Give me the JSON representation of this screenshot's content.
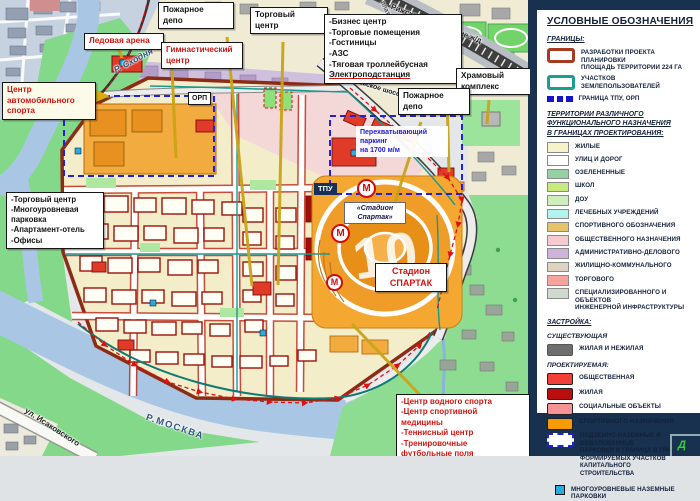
{
  "map": {
    "callouts": {
      "fire_depot_1": "Пожарное\nдепо",
      "shopping_center_top": "Торговый\nцентр",
      "business_block": "-Бизнес центр\n-Торговые помещения\n-Гостиницы\n-АЗС\n-Тяговая троллейбусная",
      "business_block_last": "Электроподстанция",
      "temple_complex": "Храмовый\nкомплекс",
      "fire_depot_2": "Пожарное\nдепо",
      "ice_arena": "Ледовая арена",
      "gym_center": "Гимнастический\nцентр",
      "auto_sport_center": "Центр\nавтомобильного\nспорта",
      "left_services": "-Торговый центр\n-Многоуровневая\nпарковка\n-Апартамент-отель\n-Офисы",
      "intercept_parking": "Перехватывающий\nпаркинг\nна 1700 м/м",
      "tpu": "ТПУ",
      "orp": "ОРП",
      "spartak_station": "«Стадион\nСпартак»",
      "stadium": "Стадион\nСПАРТАК",
      "south_sports": "-Центр водного спорта\n-Центр спортивной\nмедицины\n-Теннисный центр\n-Тренировочные\nфутбольные  поля"
    },
    "labels": {
      "river_skhodnya": "Р. Сходня",
      "river_moskva": "Р.МОСКВА",
      "isakovskogo_street": "ул. Исаковского",
      "volokolamskoe_highway": "Волоколамское шоссе",
      "railway_line": "Рижское направление ж/д",
      "platform": "платформа",
      "stadium_plot_number": "10",
      "metro_letter": "М"
    }
  },
  "legend": {
    "title": "УСЛОВНЫЕ ОБОЗНАЧЕНИЯ",
    "granitsy": {
      "header": "ГРАНИЦЫ:",
      "items": [
        {
          "label": "РАЗРАБОТКИ ПРОЕКТА ПЛАНИРОВКИ\nПЛОЩАДЬ ТЕРРИТОРИИ 224 ГА",
          "color": "#a63b20"
        },
        {
          "label": "УЧАСТКОВ ЗЕМЛЕПОЛЬЗОВАТЕЛЕЙ",
          "color": "#199e94"
        },
        {
          "label": "ГРАНИЦА ТПУ, ОРП",
          "color": "#1414cc"
        }
      ]
    },
    "territories": {
      "header": "ТЕРРИТОРИИ РАЗЛИЧНОГО\nФУНКЦИОНАЛЬНОГО   НАЗНАЧЕНИЯ\nВ ГРАНИЦАХ ПРОЕКТИРОВАНИЯ:",
      "items": [
        {
          "label": "ЖИЛЫЕ",
          "color": "#f6f3cb"
        },
        {
          "label": "УЛИЦ И ДОРОГ",
          "color": "#ffffff"
        },
        {
          "label": "ОЗЕЛЕНЕННЫЕ",
          "color": "#93d0a2"
        },
        {
          "label": "ШКОЛ",
          "color": "#c8ea7c"
        },
        {
          "label": "ДОУ",
          "color": "#cfeebb"
        },
        {
          "label": "ЛЕЧЕБНЫХ УЧРЕЖДЕНИЙ",
          "color": "#b2f3eb"
        },
        {
          "label": "СПОРТИВНОГО ОБОЗНАЧЕНИЯ",
          "color": "#e6c36a"
        },
        {
          "label": "ОБЩЕСТВЕННОГО НАЗНАЧЕНИЯ",
          "color": "#f7cad0"
        },
        {
          "label": "АДМИНИСТРАТИВНО-ДЕЛОВОГО",
          "color": "#cfb3da"
        },
        {
          "label": "ЖИЛИЩНО-КОММУНАЛЬНОГО",
          "color": "#ded3c0"
        },
        {
          "label": "ТОРГОВОГО",
          "color": "#f4a49c"
        },
        {
          "label": "СПЕЦИАЛИЗИРОВАННОГО И ОБЪЕКТОВ\nИНЖЕНЕРНОЙ ИНФРАСТРУКТУРЫ",
          "color": "#cfd9cf"
        }
      ]
    },
    "zastroika": {
      "header": "ЗАСТРОЙКА:",
      "existing_label": "СУЩЕСТВУЮЩАЯ",
      "existing_item": {
        "label": "ЖИЛАЯ И НЕЖИЛАЯ",
        "color": "#6e6e6e"
      },
      "planned_label": "ПРОЕКТИРУЕМАЯ:",
      "planned_items": [
        {
          "label": "ОБЩЕСТВЕННАЯ",
          "color": "#f04038"
        },
        {
          "label": "ЖИЛАЯ",
          "color": "#bb0d0d"
        },
        {
          "label": "СОЦИАЛЬНЫЕ ОБЪЕКТЫ",
          "color": "#f59396"
        },
        {
          "label": "СПОРТИВНОГО НАЗНАЧЕНИЯ",
          "color": "#f89b00"
        }
      ],
      "underground_parking_label": "ПОДЗЕМНО-НАЗЕМНЫЕ И ОБВАЛОВАННЫЕ\nПАРКОВКИ В ГРАНИЦА В ГРАНИЦАХ\nФОРМИРУЕМЫХ УЧАСТКОВ КАПИТАЛЬНОГО\nСТРОИТЕЛЬСТВА",
      "multilevel_parking": {
        "label": "МНОГОУРОВНЕВЫЕ НАЗЕМНЫЕ ПАРКОВКИ",
        "color": "#29abe2"
      }
    },
    "corner_button": "Д"
  }
}
